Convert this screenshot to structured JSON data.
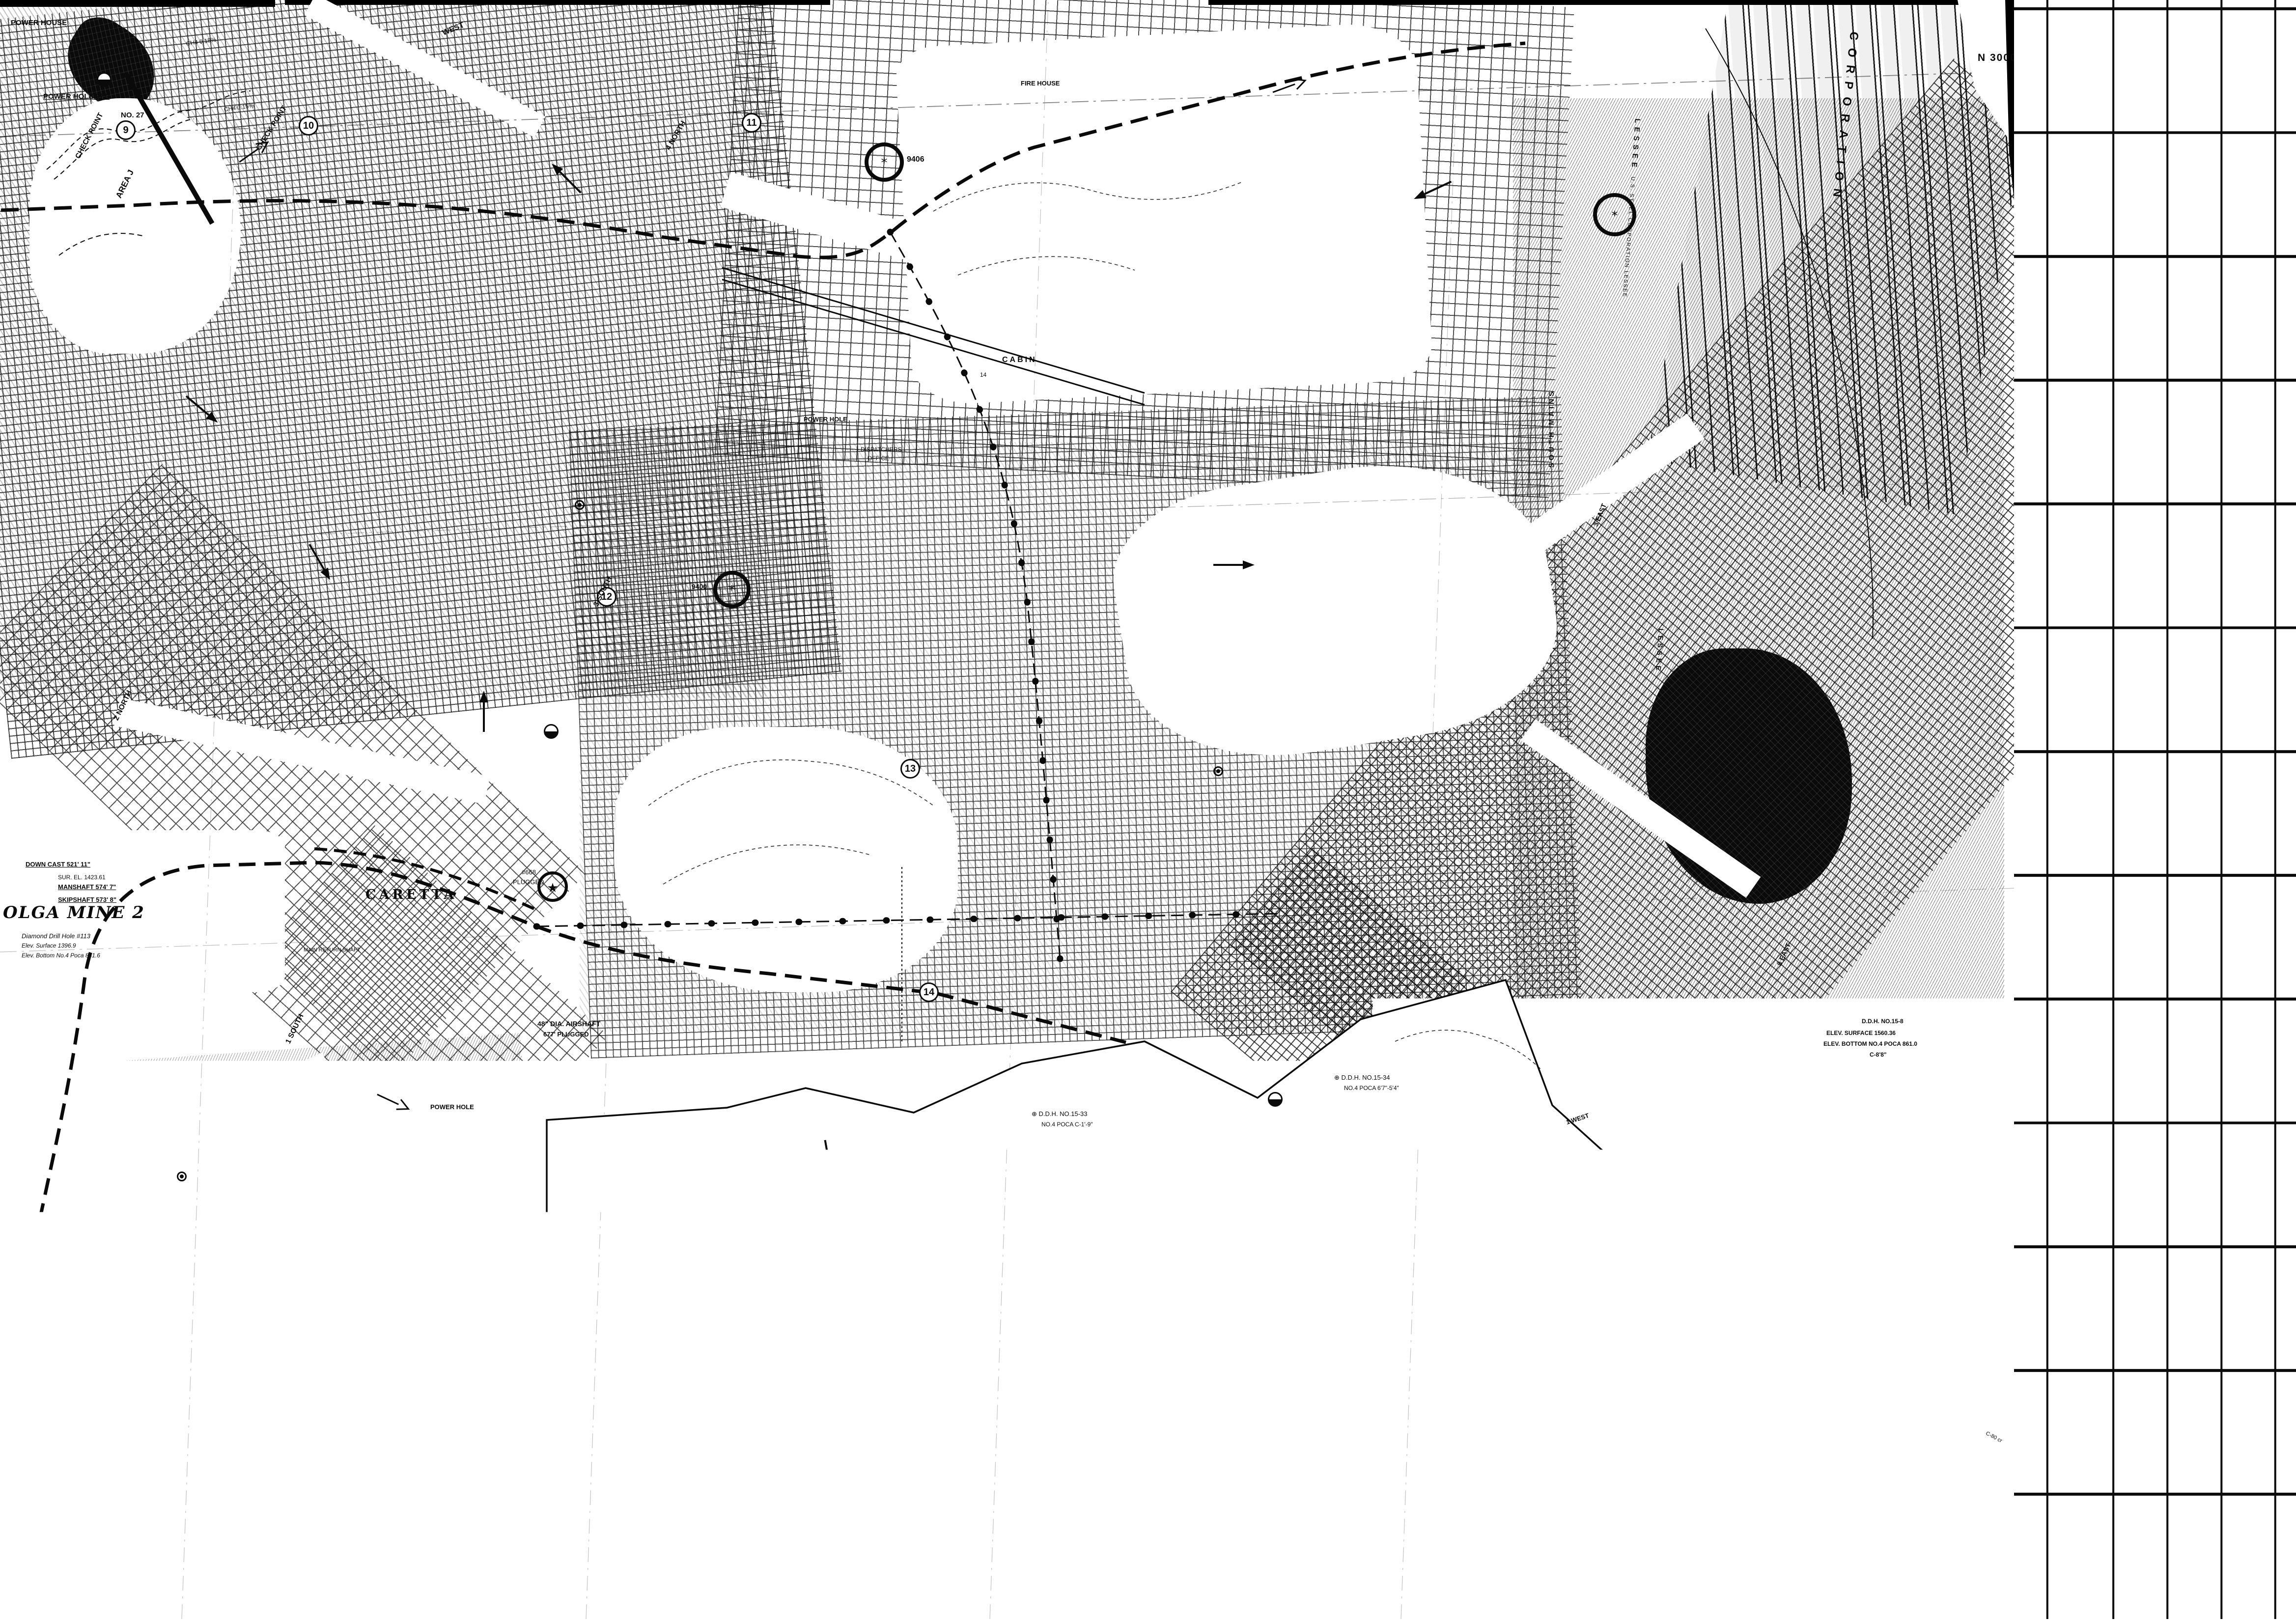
{
  "sheet": {
    "number": "4"
  },
  "title_block": {
    "line1": "MAP SHOWING",
    "line2": "DIAMOND DRILL HOLES",
    "line3": "AND",
    "line4": "MINES IN NO.4 POCAHONTAS SEAM",
    "line5": "OLGA COAL COMPANY",
    "line6": "McDOWELL COUNTY, W. VA.",
    "line7": "SCALE 1\"=500'"
  },
  "land_corporation": {
    "line1": "POCAHONTAS LAND CORPORATION",
    "line2": "UNITED STATES STEEL CORPORATION LESSEE"
  },
  "legend": {
    "heading": "LEGEND",
    "miles_example": "5",
    "items": [
      {
        "symbol": "main-line-track",
        "label": "MAIN LINE TRACK"
      },
      {
        "symbol": "miles-circle",
        "label": "MILES FROM BOTTOM NO. 2 MINE"
      },
      {
        "symbol": "airshaft",
        "label": "AIRSHAFT"
      },
      {
        "symbol": "power-bore-hole",
        "label": "POWER BORE HOLE"
      },
      {
        "symbol": "belt-line",
        "label": "BELT LINE"
      },
      {
        "symbol": "gas-well",
        "label": "GAS WELL"
      },
      {
        "symbol": "telephone",
        "label": "TELEPHONE"
      },
      {
        "symbol": "intake-air",
        "label": "INTAKE AIR"
      },
      {
        "symbol": "return-air",
        "label": "RETURN AIR"
      },
      {
        "symbol": "rectifier",
        "label": "RECTIFIER"
      },
      {
        "symbol": "fire-station",
        "label": "FIRE STATION"
      },
      {
        "symbol": "gas-pipeline",
        "label": "GAS PIPELINE"
      },
      {
        "symbol": "power-line",
        "label": "POWER LINE"
      },
      {
        "symbol": "escapeway",
        "label": "ESCAPEWAY"
      }
    ]
  },
  "scale_bar": {
    "far_left": "500",
    "zero": "0",
    "mid": "500",
    "right": "1000",
    "caption": "Scale, feet"
  },
  "grid_labels": {
    "n30000": "N 30000",
    "n25000": "N 25000",
    "e15000": "15000",
    "e20000": "E 20000",
    "e25000": "E 25000",
    "e30000": "E 30000"
  },
  "mile_markers": {
    "m1": "9",
    "m2": "10",
    "m3": "11",
    "m4": "12",
    "m5": "13",
    "m6": "14",
    "m7": "15"
  },
  "gas_wells": {
    "g9406": "9406",
    "g9400": "9400"
  },
  "map_labels": {
    "power_house": "POWER HOUSE",
    "no27": "NO. 27",
    "power_hole_971": "POWER HOLE 971'",
    "check_point": "CHECK POINT",
    "check_point2": "CHECK POINT",
    "area_j": "AREA J",
    "ch4_a": "CH4 0.15%",
    "ch4_b": "CH4 0.15%",
    "west": "WEST",
    "north4": "4 NORTH",
    "fire_house": "FIRE HOUSE",
    "cabin": "CABIN",
    "cabin14": "14",
    "power_hole": "POWER HOLE",
    "dispatchers1": "DISPATCHERS",
    "dispatchers2": "OFFICE",
    "south3": "3-SOUTH",
    "north2": "2 NORTH",
    "olga_mine": "OLGA MINE 2",
    "downcast": "DOWN CAST 521' 11\"",
    "surel": "SUR. EL. 1423.61",
    "manshaft": "MANSHAFT 574' 7\"",
    "skipshaft": "SKIPSHAFT 573' 8\"",
    "ddh113_1": "Diamond Drill Hole #113",
    "ddh113_2": "Elev. Surface 1396.9",
    "ddh113_3": "Elev. Bottom No.4 Poca 841.6",
    "caretta": "CARETTA",
    "plugged668_1": "#668",
    "plugged668_2": "PLUGGED",
    "main_return": "MAIN RETURN SHAFT",
    "airshaft48_1": "48\" DIA. AIRSHAFT",
    "airshaft48_2": "677' PLUGGED",
    "south1": "1 SOUTH",
    "power_hole2": "POWER HOLE",
    "south_mains": "SOUTH MAINS",
    "east3": "3 EAST",
    "east8": "8 EAST",
    "west1": "1 WEST",
    "east11": "11 EAST",
    "ddh158_1": "D.D.H. NO.15-8",
    "ddh158_2": "ELEV. SURFACE 1560.36",
    "ddh158_3": "ELEV. BOTTOM NO.4 POCA 861.0",
    "ddh158_4": "C-8'8\"",
    "ddh1534_1": "⊕ D.D.H. NO.15-34",
    "ddh1534_2": "NO.4 POCA 6'7\"-5'4\"",
    "ddh1533_1": "⊕ D.D.H. NO.15-33",
    "ddh1533_2": "NO.4 POCA C-1'-9\"",
    "ddh1532_1": "⊕ D.D.H. NO.15-32",
    "ddh1532_2": "NO.4 POCA C-1'-8\"",
    "ddh1535_1": "⊕ D.D.H. NO.15-35",
    "ddh1535_2": "NO.4 POCA C-10'3\"",
    "corporation": "CORPORATION",
    "lessee": "LESSEE",
    "us_steel": "U.S. STEEL CORPORATION LESSEE",
    "lessee2": "LESSEE",
    "c80": "C-80 cr"
  },
  "colors": {
    "ink": "#0a0a0a",
    "paper": "#ffffff"
  }
}
